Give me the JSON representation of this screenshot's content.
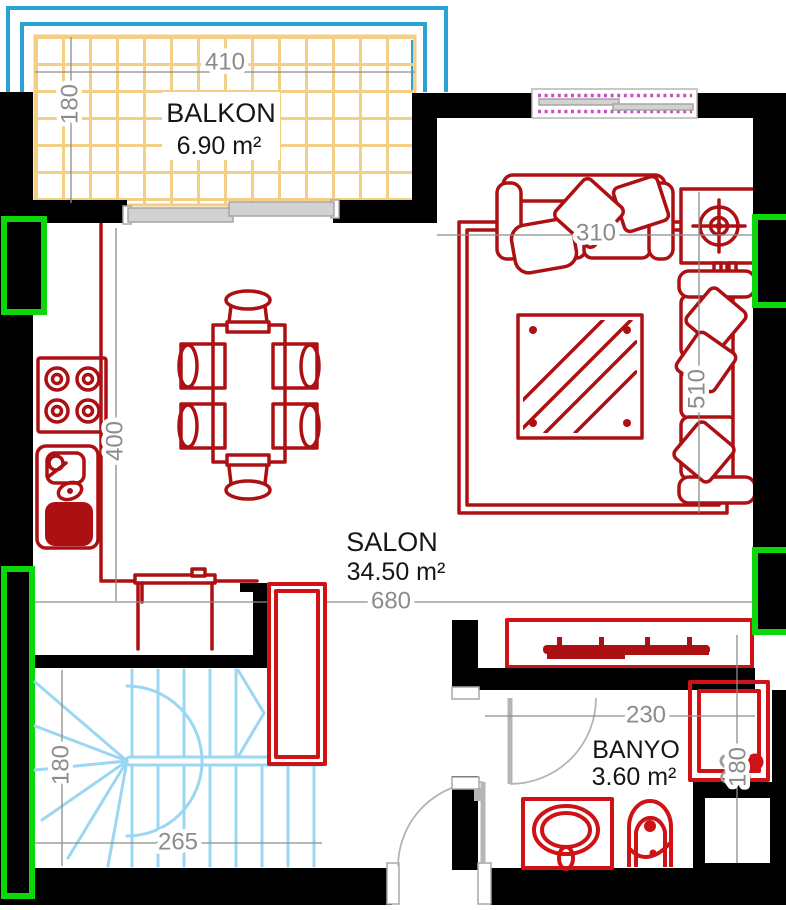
{
  "document": {
    "type": "apartment floor plan"
  },
  "colors": {
    "bg": "#ffffff",
    "wall": "#000000",
    "furniture": "#ad1013",
    "accent": "#cf1215",
    "stairs": "#9bd7f2",
    "railing": "#2aa2d4",
    "tile": "#f2cf85",
    "dim": "#8c8c8c",
    "door": "#b5b5b5",
    "panelfill": "#d2d2d2",
    "green": "#0ad80a",
    "magenta": "#c94fc9"
  },
  "rooms": {
    "balkon": {
      "label": "BALKON",
      "area": "6.90 m²"
    },
    "salon": {
      "label": "SALON",
      "area": "34.50 m²"
    },
    "banyo": {
      "label": "BANYO",
      "area": "3.60 m²"
    }
  },
  "dimensions": {
    "balkon_width": "410",
    "balkon_depth": "180",
    "sofa_wall": "310",
    "sofa_length": "510",
    "kitchen_wall": "400",
    "salon_width": "680",
    "stairs_width": "265",
    "stairs_depth": "180",
    "banyo_width": "230",
    "banyo_depth": "180"
  }
}
